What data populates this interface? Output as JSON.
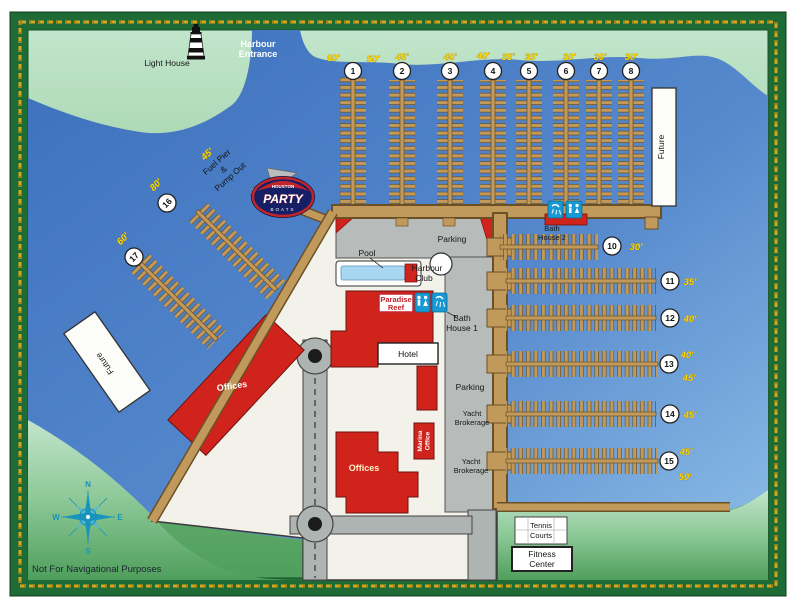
{
  "landmarks": {
    "light_house": "Light House",
    "harbour_entrance_1": "Harbour",
    "harbour_entrance_2": "Entrance",
    "disclaimer": "Not For Navigational Purposes"
  },
  "piers_top": [
    {
      "num": "1",
      "label_left": "60'",
      "label_right": "50'"
    },
    {
      "num": "2",
      "label": "45'"
    },
    {
      "num": "3",
      "label": "40'"
    },
    {
      "num": "4",
      "label_left": "40'",
      "label_right": "35'"
    },
    {
      "num": "5",
      "label": "35'"
    },
    {
      "num": "6",
      "label": "30'"
    },
    {
      "num": "7",
      "label": "30'"
    },
    {
      "num": "8",
      "label": "30'"
    }
  ],
  "piers_right": [
    {
      "num": "10",
      "label": "30'"
    },
    {
      "num": "11",
      "label": "35'"
    },
    {
      "num": "12",
      "label": "40'"
    },
    {
      "num": "13",
      "label_top": "40'",
      "label_bottom": "45'"
    },
    {
      "num": "14",
      "label": "45'"
    },
    {
      "num": "15",
      "label_top": "45'",
      "label_bottom": "50'"
    }
  ],
  "piers_left": [
    {
      "num": "16",
      "label": "80'"
    },
    {
      "num": "17",
      "label": "60'"
    }
  ],
  "fuel_pier": {
    "length": "45'",
    "line1": "Fuel Pier",
    "line2": "&",
    "line3": "Pump Out"
  },
  "party_logo": {
    "top": "HOUSTON",
    "main": "PARTY",
    "bottom": "BOATS"
  },
  "facilities": {
    "parking_top": "Parking",
    "pool": "Pool",
    "harbour_club_1": "Harbour",
    "harbour_club_2": "Club",
    "paradise_reef_1": "Paradise",
    "paradise_reef_2": "Reef",
    "bath_house_1_a": "Bath",
    "bath_house_1_b": "House 1",
    "bath_house_2_a": "Bath",
    "bath_house_2_b": "House 2",
    "hotel": "Hotel",
    "offices_west": "Offices",
    "offices_south": "Offices",
    "marina_office_1": "Marina",
    "marina_office_2": "Office",
    "parking_east": "Parking",
    "yacht_brokerage_1a": "Yacht",
    "yacht_brokerage_1b": "Brokerage",
    "yacht_brokerage_2a": "Yacht",
    "yacht_brokerage_2b": "Brokerage",
    "tennis_courts_1": "Tennis",
    "tennis_courts_2": "Courts",
    "fitness_center_1": "Fitness",
    "fitness_center_2": "Center",
    "future_north": "Future",
    "future_west": "Future"
  },
  "compass": {
    "n": "N",
    "e": "E",
    "s": "S",
    "w": "W"
  },
  "colors": {
    "water": "#4276BE",
    "water_light": "#8FC0E8",
    "land_light": "#C2E5CB",
    "land_dark": "#4F9F5C",
    "dock_tan": "#C19A5B",
    "building_red": "#CF231C",
    "pavement_gray": "#B7BCBA",
    "frame_green": "#1F6B35",
    "rope_gold": "#D9A61B",
    "label_yellow": "#FFD700",
    "icon_blue": "#1799D4",
    "pool_blue": "#A9D7F2"
  }
}
